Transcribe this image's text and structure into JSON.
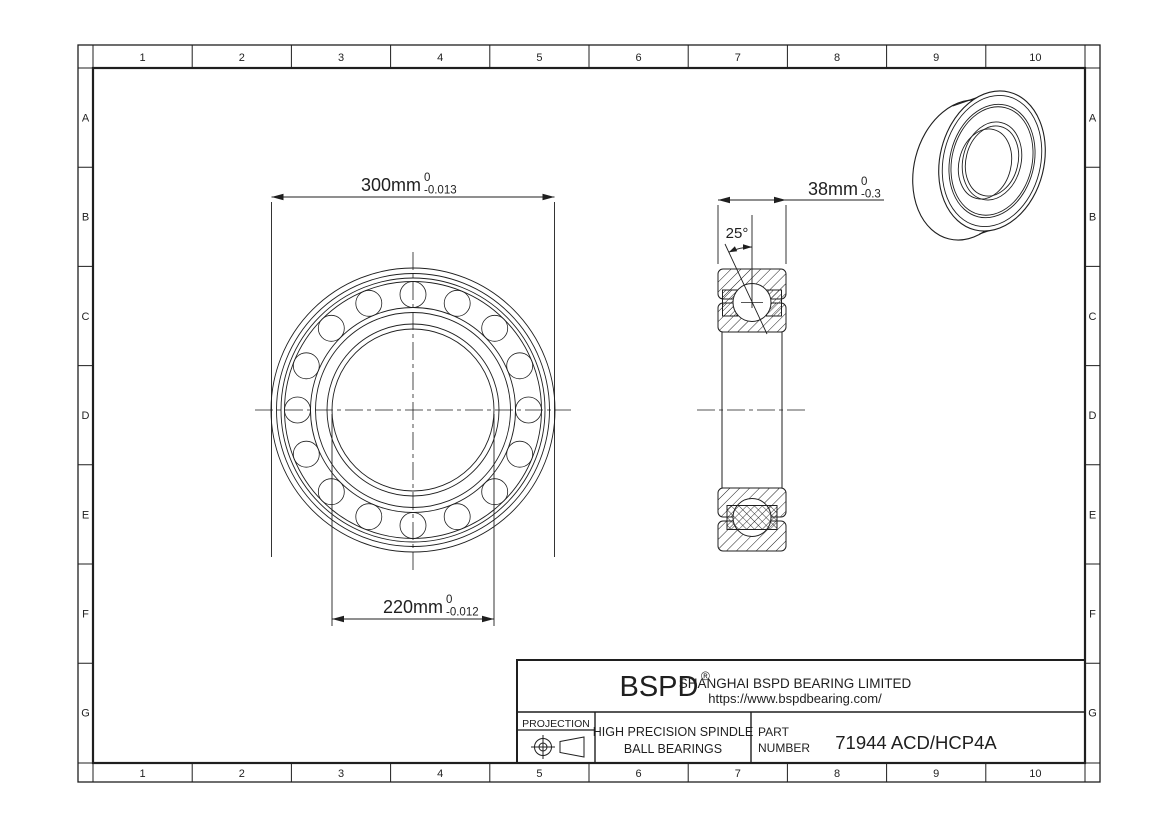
{
  "colors": {
    "line": "#1f1f1f",
    "background": "#ffffff"
  },
  "grid": {
    "columns": [
      "1",
      "2",
      "3",
      "4",
      "5",
      "6",
      "7",
      "8",
      "9",
      "10"
    ],
    "rows": [
      "A",
      "B",
      "C",
      "D",
      "E",
      "F",
      "G"
    ]
  },
  "dimensions": {
    "outer_diameter": {
      "value": "300mm",
      "tol_upper": "0",
      "tol_lower": "-0.013"
    },
    "bore_diameter": {
      "value": "220mm",
      "tol_upper": "0",
      "tol_lower": "-0.012"
    },
    "width": {
      "value": "38mm",
      "tol_upper": "0",
      "tol_lower": "-0.3"
    },
    "contact_angle": "25°"
  },
  "title_block": {
    "logo": "BSPD",
    "registered_mark": "®",
    "company": "SHANGHAI BSPD BEARING LIMITED",
    "website": "https://www.bspdbearing.com/",
    "projection_label": "PROJECTION",
    "projection_icon": "first-angle-projection-icon",
    "product_line1": "HIGH  PRECISION SPINDLE",
    "product_line2": "BALL BEARINGS",
    "part_label_line1": "PART",
    "part_label_line2": "NUMBER",
    "part_number": "71944 ACD/HCP4A"
  }
}
